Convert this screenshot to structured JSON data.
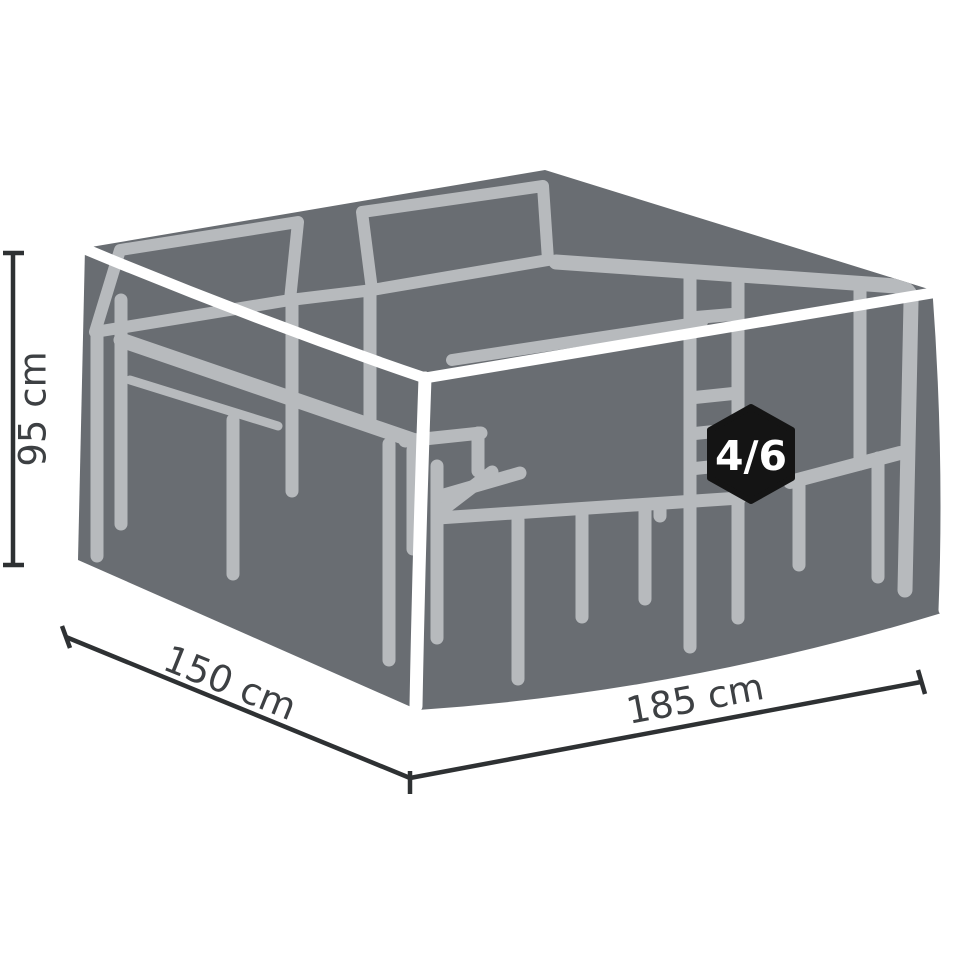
{
  "illustration": {
    "title": "furniture-cover-dimensions-diagram",
    "subject": "Protective cover over a rectangular garden dining set (table with chairs) shown as a grey cover with light furniture silhouette",
    "colors": {
      "background": "#ffffff",
      "cover": "#696d72",
      "furniture_silhouette": "#b7babd",
      "seam": "#ffffff",
      "dimension_line": "#2e3133",
      "dimension_label": "#3d4043",
      "badge_background": "#141414",
      "badge_text": "#ffffff"
    }
  },
  "dimensions": {
    "height": {
      "label": "95 cm"
    },
    "depth": {
      "label": "150 cm"
    },
    "width": {
      "label": "185 cm"
    }
  },
  "badge": {
    "label": "4/6",
    "shape": "hexagon"
  }
}
